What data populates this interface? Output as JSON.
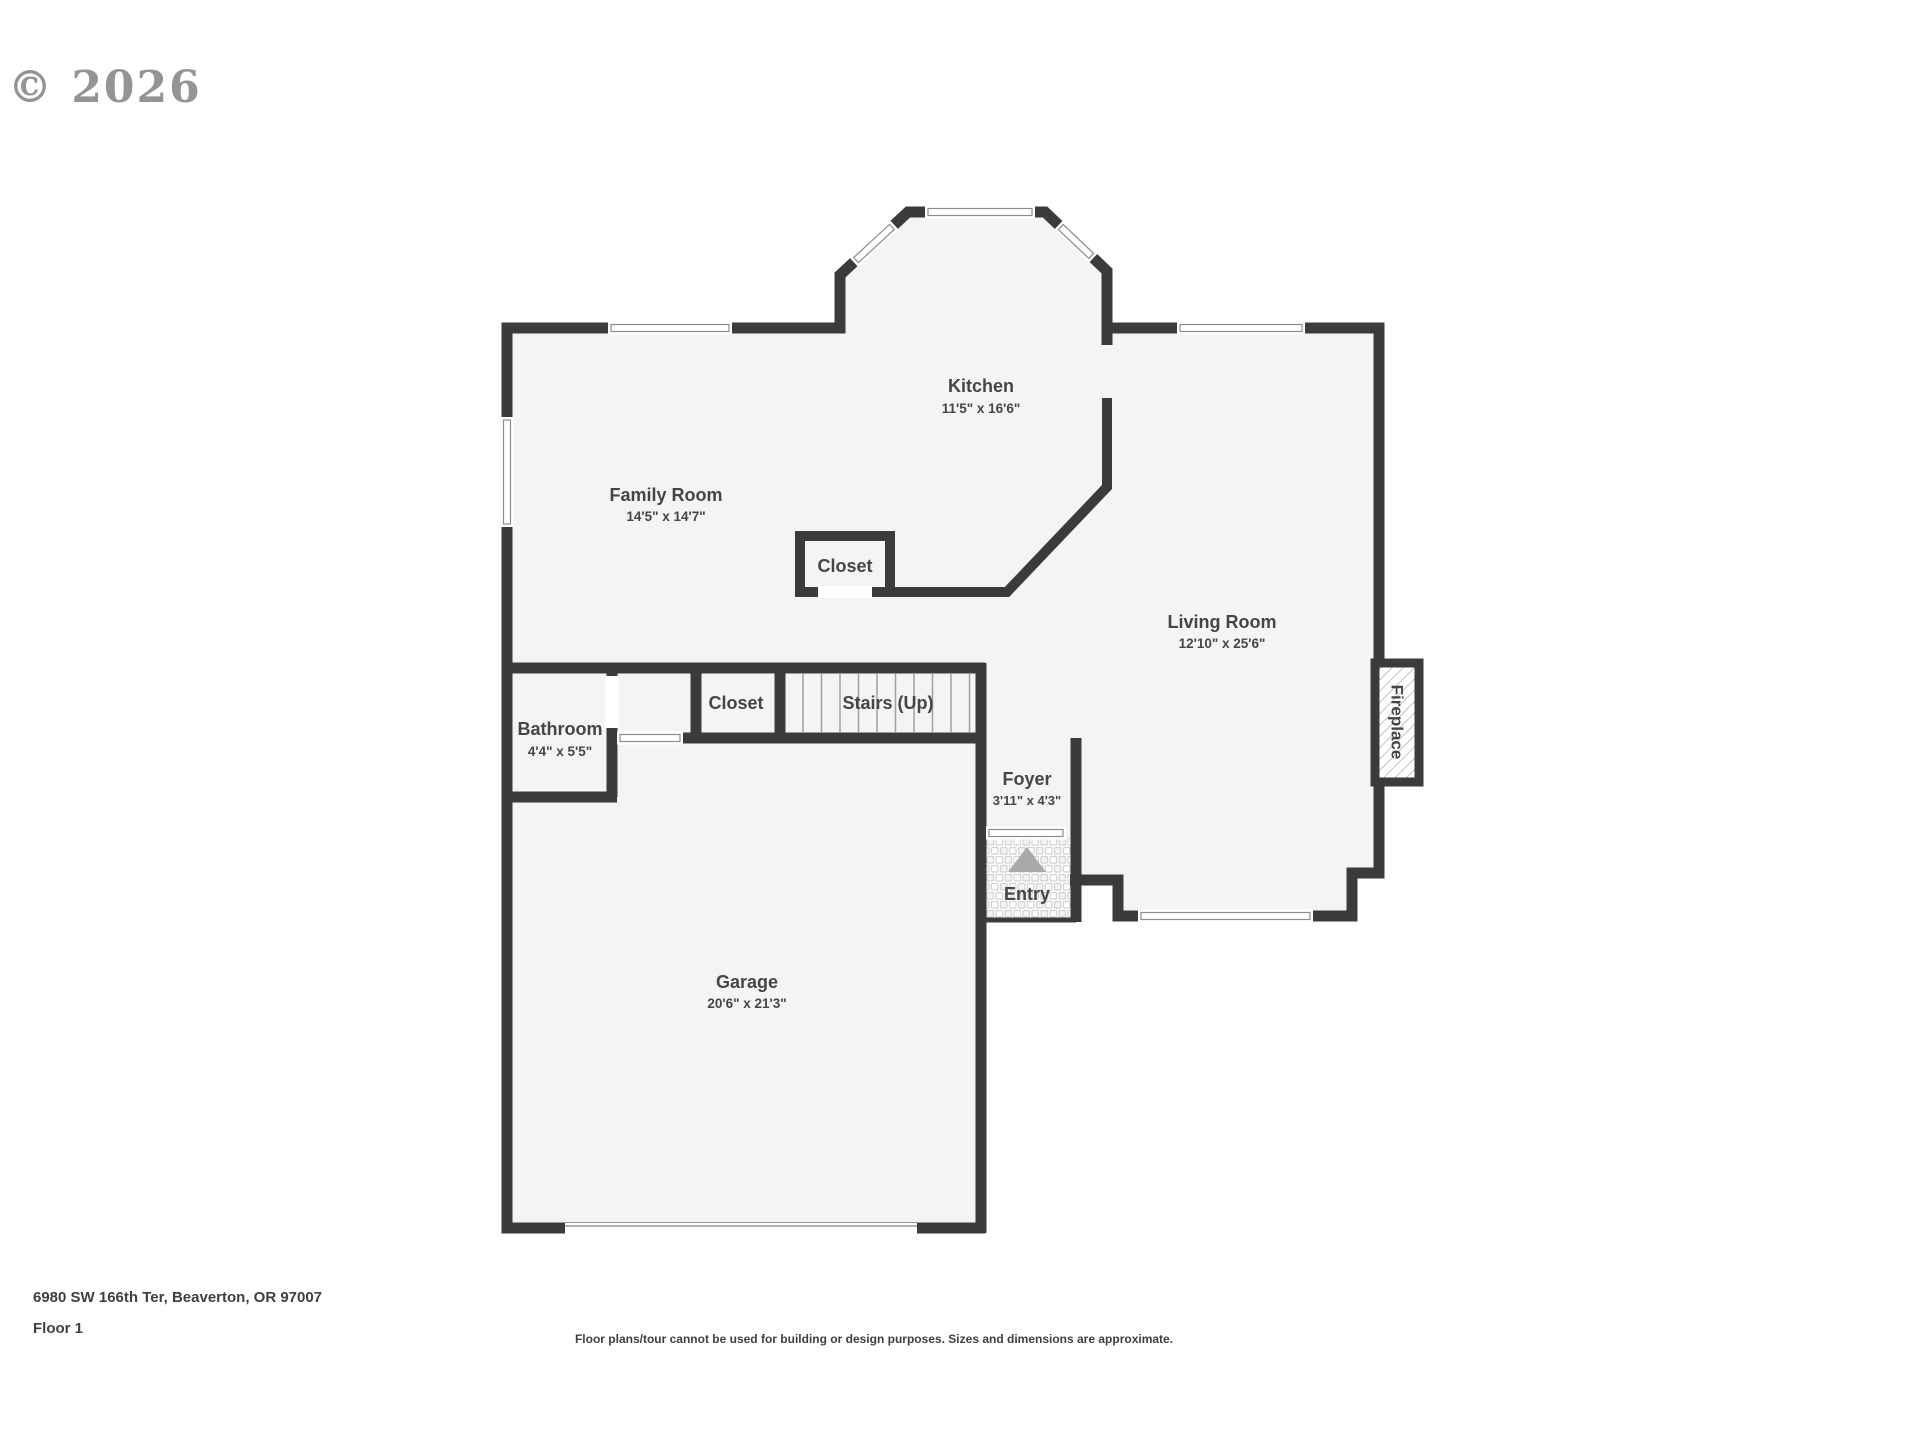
{
  "watermark": {
    "text": "© 2026"
  },
  "floor_plan": {
    "rooms": {
      "kitchen": {
        "name": "Kitchen",
        "dims": "11'5\" x 16'6\""
      },
      "family_room": {
        "name": "Family Room",
        "dims": "14'5\" x 14'7\""
      },
      "living_room": {
        "name": "Living Room",
        "dims": "12'10\" x 25'6\""
      },
      "bathroom": {
        "name": "Bathroom",
        "dims": "4'4\" x 5'5\""
      },
      "garage": {
        "name": "Garage",
        "dims": "20'6\" x 21'3\""
      },
      "foyer": {
        "name": "Foyer",
        "dims": "3'11\" x 4'3\""
      },
      "kitchen_closet": {
        "name": "Closet"
      },
      "hall_closet": {
        "name": "Closet"
      },
      "stairs": {
        "name": "Stairs (Up)"
      },
      "entry": {
        "name": "Entry"
      },
      "fireplace": {
        "name": "Fireplace"
      }
    },
    "colors": {
      "wall": "#3b3b3b",
      "floor": "#f4f4f4",
      "label": "#454545"
    }
  },
  "footer": {
    "address": "6980 SW 166th Ter, Beaverton, OR 97007",
    "floor_label": "Floor 1",
    "disclaimer": "Floor plans/tour cannot be used for building or design purposes. Sizes and dimensions are approximate."
  }
}
